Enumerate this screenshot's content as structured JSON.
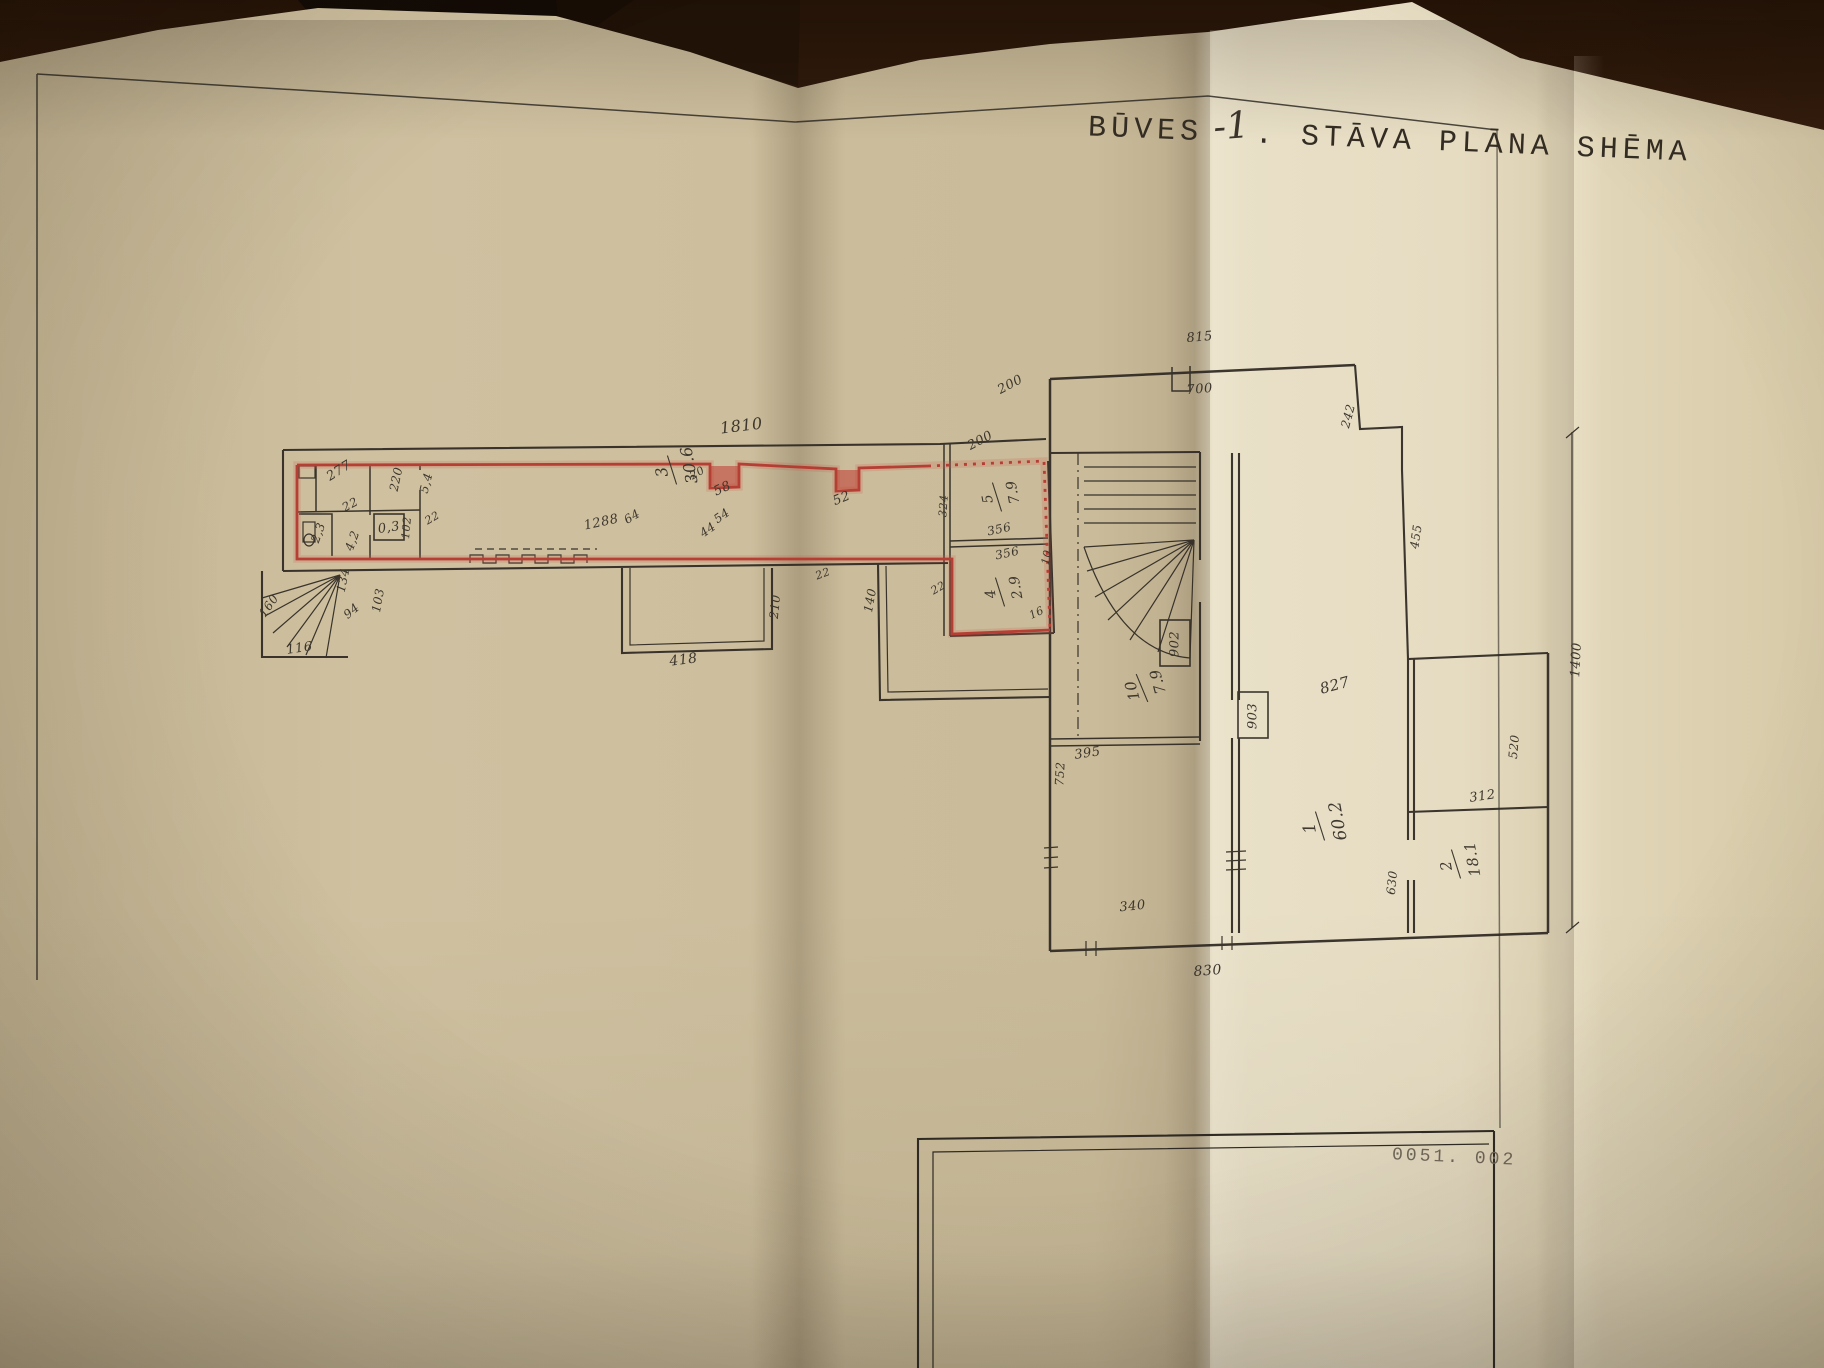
{
  "title": {
    "pre": "BŪVES",
    "floor": "-1",
    "post": ". STĀVA PLĀNA SHĒMA"
  },
  "stamp": "0051. 002",
  "colors": {
    "ink": "#2f2a24",
    "red": "#b5372e",
    "paper": "#cfc19f",
    "paper_light": "#e8dfc7",
    "wood": "#6b3d1e"
  },
  "plan": {
    "labels": [
      {
        "t": "1810",
        "x": 742,
        "y": 431,
        "r": -7,
        "s": 16
      },
      {
        "t": "277",
        "x": 341,
        "y": 474,
        "r": -32,
        "s": 13
      },
      {
        "t": "220",
        "x": 400,
        "y": 480,
        "r": -78,
        "s": 12
      },
      {
        "t": "5,4",
        "x": 430,
        "y": 484,
        "r": -75,
        "s": 12
      },
      {
        "t": "22",
        "x": 352,
        "y": 508,
        "r": -28,
        "s": 12
      },
      {
        "t": "2,3",
        "x": 322,
        "y": 534,
        "r": -70,
        "s": 12
      },
      {
        "t": "4,2",
        "x": 356,
        "y": 542,
        "r": -70,
        "s": 12
      },
      {
        "t": "102",
        "x": 410,
        "y": 528,
        "r": -85,
        "s": 11
      },
      {
        "t": "22",
        "x": 434,
        "y": 521,
        "r": -30,
        "s": 11
      },
      {
        "t": "1288",
        "x": 602,
        "y": 526,
        "r": -12,
        "s": 13
      },
      {
        "t": "64",
        "x": 634,
        "y": 520,
        "r": -30,
        "s": 12
      },
      {
        "t": "20",
        "x": 699,
        "y": 476,
        "r": -30,
        "s": 11
      },
      {
        "t": "58",
        "x": 724,
        "y": 492,
        "r": -25,
        "s": 13
      },
      {
        "t": "54",
        "x": 724,
        "y": 519,
        "r": -35,
        "s": 12
      },
      {
        "t": "44",
        "x": 710,
        "y": 533,
        "r": -35,
        "s": 12
      },
      {
        "t": "52",
        "x": 843,
        "y": 502,
        "r": -22,
        "s": 13
      },
      {
        "t": "22",
        "x": 824,
        "y": 577,
        "r": -20,
        "s": 11
      },
      {
        "t": "356",
        "x": 1000,
        "y": 533,
        "r": -12,
        "s": 12
      },
      {
        "t": "356",
        "x": 1008,
        "y": 557,
        "r": -12,
        "s": 12
      },
      {
        "t": "324",
        "x": 947,
        "y": 506,
        "r": -86,
        "s": 11
      },
      {
        "t": "22",
        "x": 940,
        "y": 591,
        "r": -30,
        "s": 11
      },
      {
        "t": "16",
        "x": 1038,
        "y": 616,
        "r": -25,
        "s": 11
      },
      {
        "t": "10",
        "x": 1050,
        "y": 558,
        "r": -78,
        "s": 11
      },
      {
        "t": "200",
        "x": 1012,
        "y": 388,
        "r": -28,
        "s": 13
      },
      {
        "t": "200",
        "x": 982,
        "y": 444,
        "r": -28,
        "s": 13
      },
      {
        "t": "134",
        "x": 347,
        "y": 581,
        "r": -78,
        "s": 12
      },
      {
        "t": "103",
        "x": 382,
        "y": 601,
        "r": -80,
        "s": 12
      },
      {
        "t": "94",
        "x": 354,
        "y": 614,
        "r": -40,
        "s": 12
      },
      {
        "t": "160",
        "x": 272,
        "y": 608,
        "r": -55,
        "s": 12
      },
      {
        "t": "116",
        "x": 300,
        "y": 652,
        "r": -8,
        "s": 13
      },
      {
        "t": "140",
        "x": 874,
        "y": 601,
        "r": -80,
        "s": 12
      },
      {
        "t": "418",
        "x": 684,
        "y": 664,
        "r": -7,
        "s": 14
      },
      {
        "t": "210",
        "x": 779,
        "y": 607,
        "r": -84,
        "s": 12
      },
      {
        "t": "395",
        "x": 1088,
        "y": 757,
        "r": -8,
        "s": 13
      },
      {
        "t": "815",
        "x": 1200,
        "y": 341,
        "r": -5,
        "s": 13
      },
      {
        "t": "700",
        "x": 1200,
        "y": 393,
        "r": -5,
        "s": 13
      },
      {
        "t": "242",
        "x": 1352,
        "y": 417,
        "r": -75,
        "s": 12
      },
      {
        "t": "455",
        "x": 1420,
        "y": 537,
        "r": -82,
        "s": 12
      },
      {
        "t": "1400",
        "x": 1580,
        "y": 660,
        "r": -87,
        "s": 13
      },
      {
        "t": "520",
        "x": 1518,
        "y": 747,
        "r": -85,
        "s": 12
      },
      {
        "t": "312",
        "x": 1483,
        "y": 800,
        "r": -8,
        "s": 13
      },
      {
        "t": "630",
        "x": 1396,
        "y": 883,
        "r": -84,
        "s": 12
      },
      {
        "t": "752",
        "x": 1064,
        "y": 774,
        "r": -87,
        "s": 12
      },
      {
        "t": "340",
        "x": 1133,
        "y": 910,
        "r": -6,
        "s": 13
      },
      {
        "t": "830",
        "x": 1208,
        "y": 975,
        "r": -4,
        "s": 14
      },
      {
        "t": "827",
        "x": 1336,
        "y": 690,
        "r": -15,
        "s": 15
      }
    ],
    "rooms": [
      {
        "num": "3",
        "den": "30.6",
        "x": 672,
        "y": 470,
        "r": -100,
        "s": 16
      },
      {
        "num": "5",
        "den": "7.9",
        "x": 997,
        "y": 497,
        "r": -100,
        "s": 14
      },
      {
        "num": "4",
        "den": "2.9",
        "x": 1000,
        "y": 592,
        "r": -100,
        "s": 14
      },
      {
        "num": "10",
        "den": "7.9",
        "x": 1142,
        "y": 688,
        "r": -105,
        "s": 15
      },
      {
        "num": "1",
        "den": "60.2",
        "x": 1320,
        "y": 826,
        "r": -100,
        "s": 17
      },
      {
        "num": "2",
        "den": "18.1",
        "x": 1456,
        "y": 864,
        "r": -100,
        "s": 15
      }
    ],
    "boxes": [
      {
        "t": "0,3",
        "x": 374,
        "y": 514,
        "w": 30,
        "h": 26,
        "tr": -8
      },
      {
        "t": "902",
        "x": 1160,
        "y": 620,
        "w": 30,
        "h": 46,
        "tr": -90
      },
      {
        "t": "903",
        "x": 1238,
        "y": 692,
        "w": 30,
        "h": 46,
        "tr": -90
      }
    ]
  }
}
